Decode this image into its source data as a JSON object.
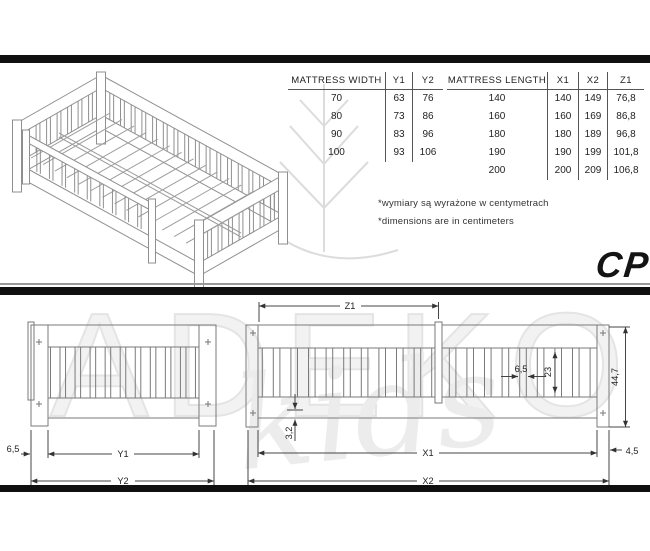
{
  "brand": {
    "model_label": "CP",
    "watermark_primary": "ADEKO",
    "watermark_secondary": "kids"
  },
  "tables": {
    "width": {
      "headers": [
        "MATTRESS WIDTH",
        "Y1",
        "Y2"
      ],
      "rows": [
        [
          "70",
          "63",
          "76"
        ],
        [
          "80",
          "73",
          "86"
        ],
        [
          "90",
          "83",
          "96"
        ],
        [
          "100",
          "93",
          "106"
        ]
      ]
    },
    "length": {
      "headers": [
        "MATTRESS LENGTH",
        "X1",
        "X2",
        "Z1"
      ],
      "rows": [
        [
          "140",
          "140",
          "149",
          "76,8"
        ],
        [
          "160",
          "160",
          "169",
          "86,8"
        ],
        [
          "180",
          "180",
          "189",
          "96,8"
        ],
        [
          "190",
          "190",
          "199",
          "101,8"
        ],
        [
          "200",
          "200",
          "209",
          "106,8"
        ]
      ]
    }
  },
  "notes": {
    "pl": "*wymiary są wyrażone w centymetrach",
    "en": "*dimensions are in centimeters"
  },
  "dimensions": {
    "end_view": {
      "post_width": "6,5",
      "inner_width": "Y1",
      "outer_width": "Y2"
    },
    "side_view": {
      "barrier_length": "Z1",
      "slat_spacing": "6,5",
      "slat_height": "23",
      "total_height": "44,7",
      "rail_lip": "3,2",
      "inner_length": "X1",
      "post_width": "4,5",
      "outer_length": "X2"
    }
  }
}
